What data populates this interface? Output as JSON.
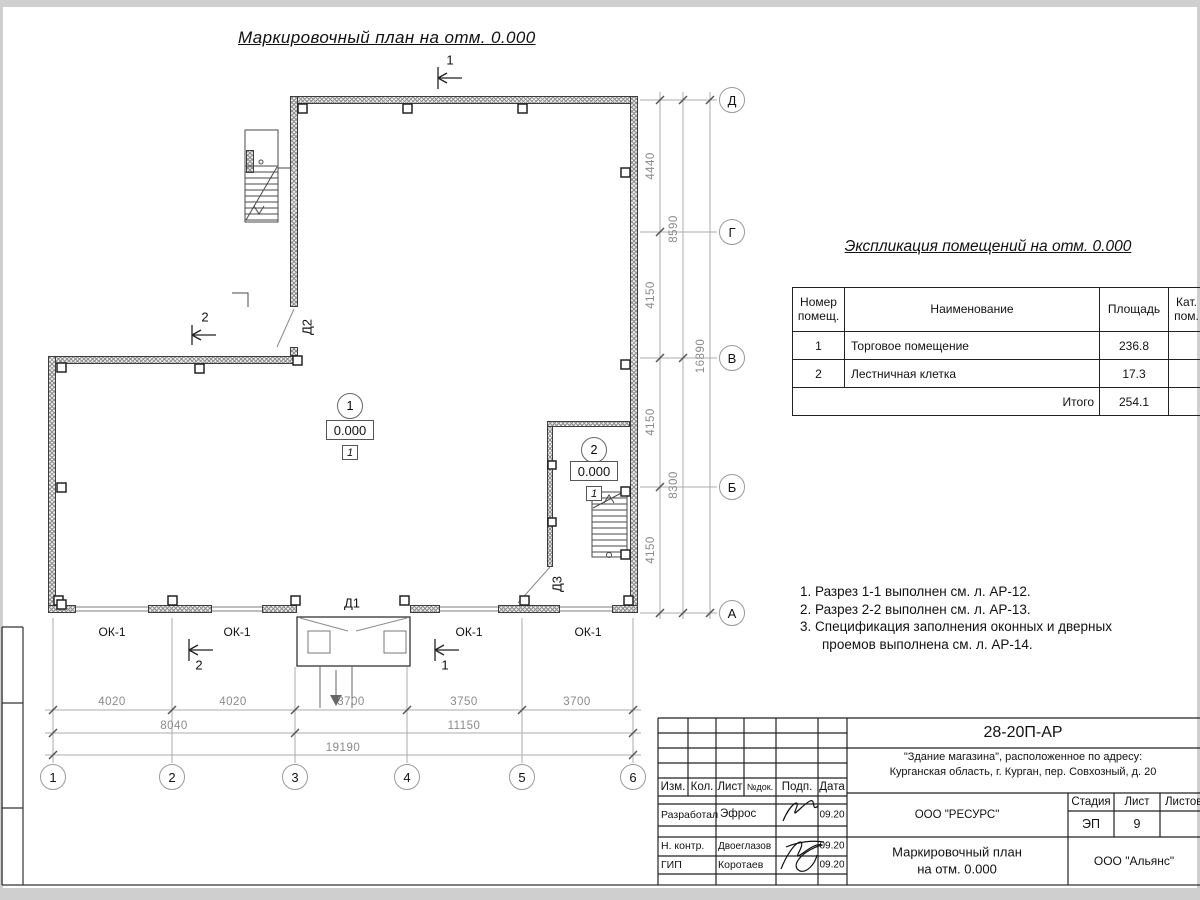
{
  "sheet": {
    "plan_title": "Маркировочный план на отм. 0.000"
  },
  "plan": {
    "doors": {
      "d1": "Д1",
      "d2": "Д2",
      "d3": "Д3"
    },
    "window_label": "ОК-1",
    "rooms": [
      {
        "number": "1",
        "elevation": "0.000",
        "floor_type": "1"
      },
      {
        "number": "2",
        "elevation": "0.000",
        "floor_type": "1"
      }
    ],
    "section_marks": {
      "top": "1",
      "left": "2",
      "bottom_left": "2",
      "bottom_right": "1"
    }
  },
  "axes": {
    "bottom": [
      "1",
      "2",
      "3",
      "4",
      "5",
      "6"
    ],
    "right": [
      "Д",
      "Г",
      "В",
      "Б",
      "А"
    ]
  },
  "dimensions": {
    "bottom_row1": [
      "4020",
      "4020",
      "3700",
      "3750",
      "3700"
    ],
    "bottom_row2": [
      "8040",
      "11150"
    ],
    "bottom_total": "19190",
    "right_col1": [
      "4440",
      "4150",
      "4150",
      "4150"
    ],
    "right_col2": [
      "8590",
      "8300"
    ],
    "right_total": "16890"
  },
  "explication": {
    "title": "Экспликация помещений на отм. 0.000",
    "headers": [
      "Номер помещ.",
      "Наименование",
      "Площадь",
      "Кат. пом."
    ],
    "rows": [
      {
        "num": "1",
        "name": "Торговое помещение",
        "area": "236.8",
        "cat": ""
      },
      {
        "num": "2",
        "name": "Лестничная клетка",
        "area": "17.3",
        "cat": ""
      }
    ],
    "total_label": "Итого",
    "total_area": "254.1"
  },
  "notes": {
    "lines": [
      "1. Разрез 1-1 выполнен см. л. АР-12.",
      "2. Разрез 2-2 выполнен см. л. АР-13.",
      "3. Спецификация заполнения оконных и дверных",
      "проемов выполнена см. л. АР-14."
    ]
  },
  "title_block": {
    "doc_code": "28-20П-АР",
    "address_line1": "\"Здание магазина\", расположенное по адресу:",
    "address_line2": "Курганская область, г. Курган, пер. Совхозный, д. 20",
    "columns": [
      "Изм.",
      "Кол.",
      "Лист",
      "№док.",
      "Подп.",
      "Дата"
    ],
    "roles": [
      {
        "label": "Разработал",
        "name": "Эфрос",
        "date": "09.20"
      },
      {
        "label": "Н. контр.",
        "name": "Двоеглазов",
        "date": "09.20"
      },
      {
        "label": "ГИП",
        "name": "Коротаев",
        "date": "09.20"
      }
    ],
    "designer_org": "ООО \"РЕСУРС\"",
    "stage_header": "Стадия",
    "sheet_header": "Лист",
    "sheets_header": "Листов",
    "stage": "ЭП",
    "sheet_number": "9",
    "drawing_name_line1": "Маркировочный план",
    "drawing_name_line2": "на отм. 0.000",
    "client_org": "ООО \"Альянс\""
  }
}
